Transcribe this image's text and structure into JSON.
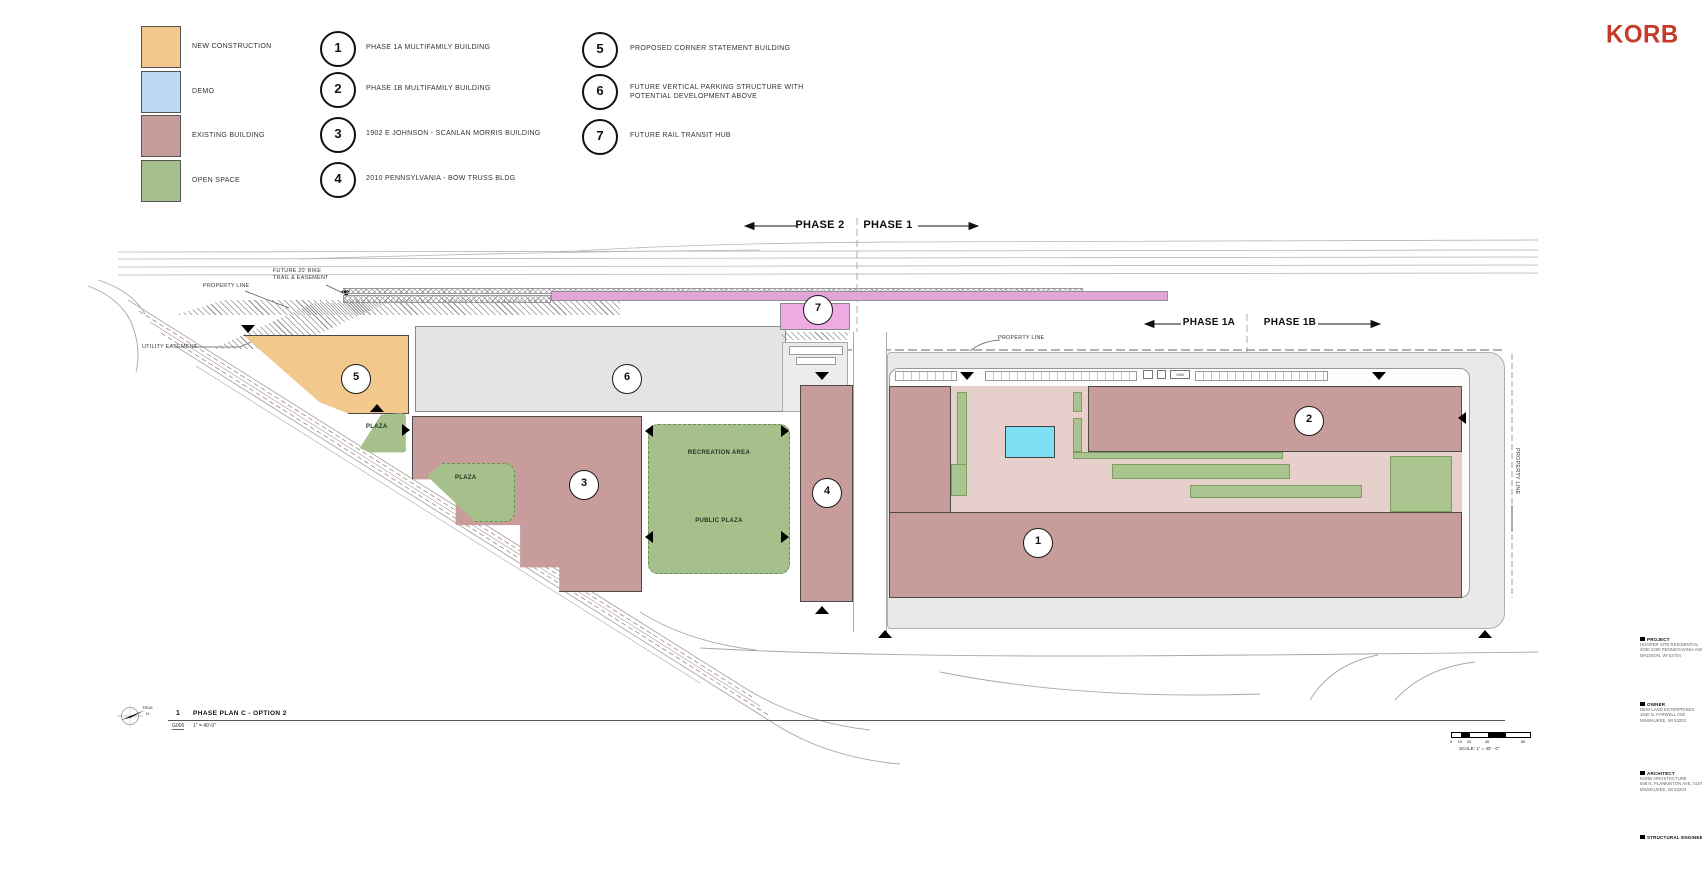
{
  "brand": {
    "name": "KORB",
    "color": "#c63a28"
  },
  "legend": {
    "swatches": [
      {
        "label": "NEW CONSTRUCTION",
        "color": "#f3c88c"
      },
      {
        "label": "DEMO",
        "color": "#bcd8f3"
      },
      {
        "label": "EXISTING BUILDING",
        "color": "#c79c9b"
      },
      {
        "label": "OPEN SPACE",
        "color": "#a5c08b"
      }
    ],
    "notes": [
      {
        "num": "1",
        "label": "PHASE 1A MULTIFAMILY BUILDING"
      },
      {
        "num": "2",
        "label": "PHASE 1B MULTIFAMILY BUILDING"
      },
      {
        "num": "3",
        "label": "1902 E JOHNSON - SCANLAN MORRIS BUILDING"
      },
      {
        "num": "4",
        "label": "2010 PENNSYLVANIA - BOW TRUSS BLDG"
      },
      {
        "num": "5",
        "label": "PROPOSED CORNER STATEMENT BUILDING"
      },
      {
        "num": "6",
        "label": "FUTURE VERTICAL PARKING STRUCTURE WITH POTENTIAL DEVELOPMENT ABOVE"
      },
      {
        "num": "7",
        "label": "FUTURE RAIL TRANSIT HUB"
      }
    ]
  },
  "header_phases": {
    "left": "PHASE 2",
    "right": "PHASE 1"
  },
  "site_phases": {
    "left": "PHASE 1A",
    "right": "PHASE 1B"
  },
  "annotations": {
    "property_line": "PROPERTY LINE",
    "bike_trail": "FUTURE 20' BIKE TRAIL & EASEMENT",
    "utility_easement": "UTILITY EASEMENT",
    "plaza": "PLAZA",
    "recreation_area": "RECREATION AREA",
    "public_plaza": "PUBLIC PLAZA",
    "van": "VAN"
  },
  "titleblock": {
    "number": "1",
    "title": "PHASE PLAN C - OPTION 2",
    "sheet": "G006",
    "scale": "1\" = 40'-0\"",
    "north_true": "TRUE",
    "north_n": "N"
  },
  "scalebar": {
    "ticks": [
      "0",
      "10",
      "20",
      "40",
      "80"
    ],
    "label": "SCALE: 1\" = 40' - 0\""
  },
  "info_column": {
    "blocks": [
      {
        "header": "PROJECT",
        "lines": [
          "HOOPER SITE RESIDENTIAL",
          "2030-2200 PENNSYLVANIA AVENUE",
          "MADISON, WI 53704"
        ]
      },
      {
        "header": "OWNER",
        "lines": [
          "NEW LAND ENTERPRISES",
          "1840 N. FARWELL AVE",
          "MILWAUKEE, WI 53202"
        ]
      },
      {
        "header": "ARCHITECT",
        "lines": [
          "KORB ARCHITECTURE",
          "648 N. PLANKINTON AVE, SUITE 240",
          "MILWAUKEE, WI 53203"
        ]
      },
      {
        "header": "STRUCTURAL ENGINEER",
        "lines": []
      }
    ]
  },
  "palette": {
    "new_construction": "#f3c88c",
    "demo": "#bcd8f3",
    "existing_building": "#c79c9b",
    "open_space": "#a5c08b",
    "parking_structure_gray": "#e4e4e4",
    "rail_bar_pink": "#e3a4da",
    "transit_hub_pink": "#eeaae2",
    "courtyard_pink": "#e7cfcb",
    "pool_cyan": "#7edff2",
    "street_gray": "#e9e9e9",
    "logo_red": "#c63a28"
  }
}
